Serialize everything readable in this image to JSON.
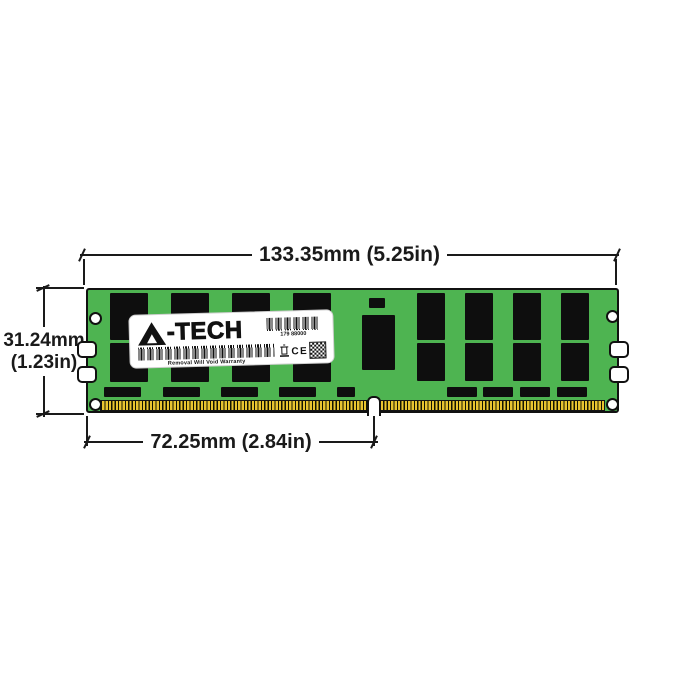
{
  "dimensions": {
    "width": {
      "label": "133.35mm (5.25in)"
    },
    "height": {
      "line1": "31.24mm",
      "line2": "(1.23in)"
    },
    "pin_span": {
      "label": "72.25mm (2.84in)"
    }
  },
  "label": {
    "brand": "A-TECH",
    "logo_suffix": "-TECH",
    "serial": "179 88000",
    "warranty": "Removal Will Void Warranty",
    "ce": "CE",
    "icons": [
      "a-triangle-logo",
      "barcode",
      "barcode",
      "weee-bin",
      "ce-mark",
      "qr-code"
    ]
  },
  "colors": {
    "pcb_green": "#4eb451",
    "chip_black": "#0e0e0e",
    "pin_gold": "#e9c430",
    "line": "#1a1a1a",
    "label_bg": "#ffffff"
  },
  "module": {
    "chips": [
      {
        "x": 22,
        "y": 3,
        "w": 38,
        "h": 47
      },
      {
        "x": 83,
        "y": 3,
        "w": 38,
        "h": 47
      },
      {
        "x": 144,
        "y": 3,
        "w": 38,
        "h": 47
      },
      {
        "x": 205,
        "y": 3,
        "w": 38,
        "h": 47
      },
      {
        "x": 22,
        "y": 53,
        "w": 38,
        "h": 39
      },
      {
        "x": 83,
        "y": 53,
        "w": 38,
        "h": 39
      },
      {
        "x": 144,
        "y": 53,
        "w": 38,
        "h": 39
      },
      {
        "x": 205,
        "y": 53,
        "w": 38,
        "h": 39
      },
      {
        "x": 329,
        "y": 3,
        "w": 28,
        "h": 47
      },
      {
        "x": 377,
        "y": 3,
        "w": 28,
        "h": 47
      },
      {
        "x": 425,
        "y": 3,
        "w": 28,
        "h": 47
      },
      {
        "x": 473,
        "y": 3,
        "w": 28,
        "h": 47
      },
      {
        "x": 329,
        "y": 53,
        "w": 28,
        "h": 38
      },
      {
        "x": 377,
        "y": 53,
        "w": 28,
        "h": 38
      },
      {
        "x": 425,
        "y": 53,
        "w": 28,
        "h": 38
      },
      {
        "x": 473,
        "y": 53,
        "w": 28,
        "h": 38
      },
      {
        "x": 274,
        "y": 25,
        "w": 33,
        "h": 55
      },
      {
        "x": 281,
        "y": 8,
        "w": 16,
        "h": 10
      },
      {
        "x": 16,
        "y": 97,
        "w": 37,
        "h": 10
      },
      {
        "x": 75,
        "y": 97,
        "w": 37,
        "h": 10
      },
      {
        "x": 133,
        "y": 97,
        "w": 37,
        "h": 10
      },
      {
        "x": 191,
        "y": 97,
        "w": 37,
        "h": 10
      },
      {
        "x": 249,
        "y": 97,
        "w": 18,
        "h": 10
      },
      {
        "x": 359,
        "y": 97,
        "w": 30,
        "h": 10
      },
      {
        "x": 395,
        "y": 97,
        "w": 30,
        "h": 10
      },
      {
        "x": 432,
        "y": 97,
        "w": 30,
        "h": 10
      },
      {
        "x": 469,
        "y": 97,
        "w": 30,
        "h": 10
      }
    ]
  }
}
